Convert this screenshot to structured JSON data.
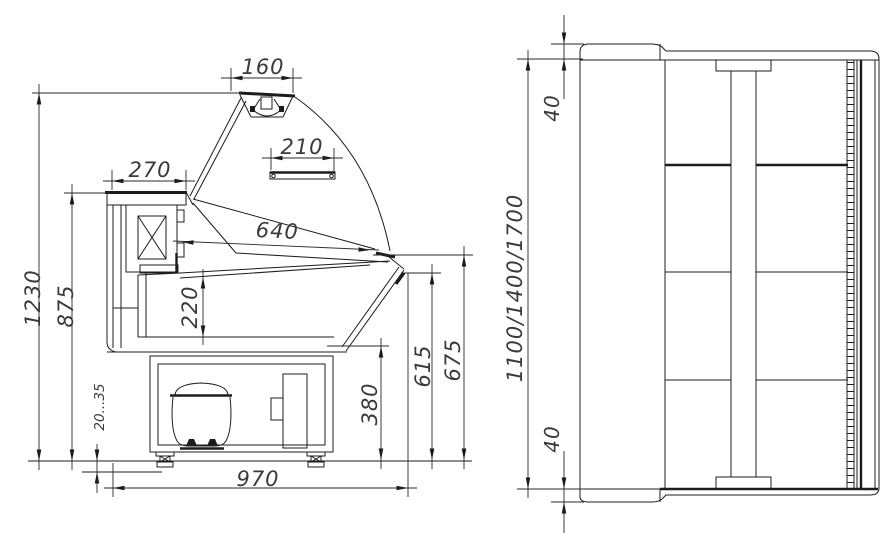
{
  "drawing": {
    "type": "technical-dimensional-drawing",
    "subject": "refrigerated-display-case",
    "colors": {
      "line": "#1c1c1c",
      "dimension_text": "#3a3a3a",
      "background": "#ffffff"
    },
    "dimensions": {
      "canopy_width": "160",
      "top_shelf_width": "210",
      "worktop_depth": "270",
      "display_opening_depth": "640",
      "well_depth": "220",
      "overall_height": "1230",
      "worktop_height": "875",
      "foot_adjustment": "20...35",
      "overall_depth": "970",
      "machine_compartment_height": "380",
      "front_lower_height": "615",
      "front_upper_height": "675",
      "top_trim": "40",
      "overall_length": "1100/1400/1700",
      "bottom_trim": "40"
    }
  }
}
